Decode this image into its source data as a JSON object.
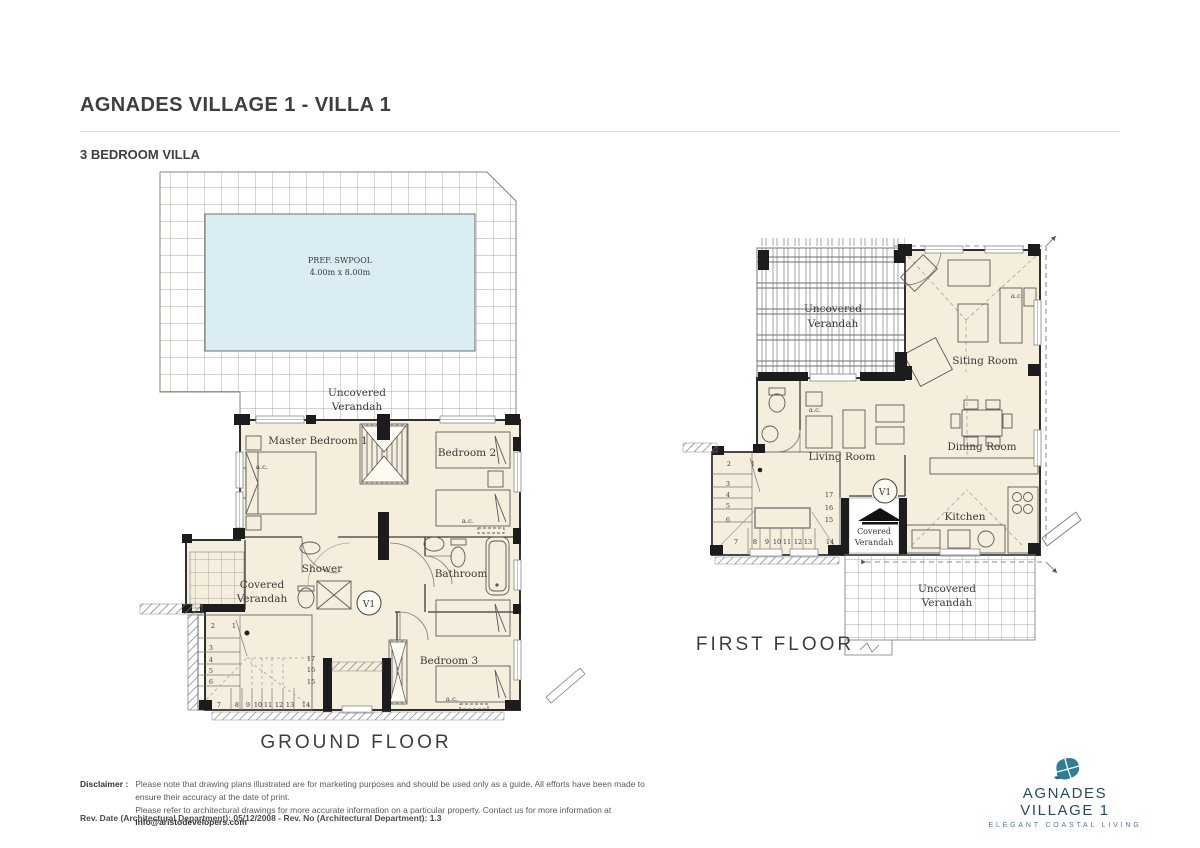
{
  "header": {
    "title": "AGNADES VILLAGE 1 - VILLA 1",
    "subtitle": "3 BEDROOM VILLA"
  },
  "ground_floor": {
    "floor_label": "GROUND FLOOR",
    "pool_label_line1": "PREF. SWPOOL",
    "pool_label_line2": "4.00m x 8.00m",
    "uncovered_verandah_line1": "Uncovered",
    "uncovered_verandah_line2": "Verandah",
    "covered_verandah_line1": "Covered",
    "covered_verandah_line2": "Verandah",
    "master_bedroom": "Master Bedroom 1",
    "bedroom2": "Bedroom 2",
    "bedroom3": "Bedroom 3",
    "shower": "Shower",
    "bathroom": "Bathroom",
    "vent_label": "V1",
    "ac_label": "a.c.",
    "stair_numbers": [
      "1",
      "2",
      "3",
      "4",
      "5",
      "6",
      "7",
      "8",
      "9",
      "10",
      "11",
      "12",
      "13",
      "14",
      "15",
      "16",
      "17"
    ]
  },
  "first_floor": {
    "floor_label": "FIRST FLOOR",
    "uncovered_verandah_top_line1": "Uncovered",
    "uncovered_verandah_top_line2": "Verandah",
    "uncovered_verandah_bottom_line1": "Uncovered",
    "uncovered_verandah_bottom_line2": "Verandah",
    "covered_verandah_line1": "Covered",
    "covered_verandah_line2": "Verandah",
    "siting_room": "Siting Room",
    "living_room": "Living Room",
    "dining_room": "Dining Room",
    "kitchen": "Kitchen",
    "vent_label": "V1",
    "ac_label": "a.c.",
    "stair_numbers": [
      "1",
      "2",
      "3",
      "4",
      "5",
      "6",
      "7",
      "8",
      "9",
      "10",
      "11",
      "12",
      "13",
      "14",
      "15",
      "16",
      "17"
    ]
  },
  "footer": {
    "disclaimer_label": "Disclaimer :",
    "disclaimer_line1": "Please note that drawing plans illustrated are for marketing purposes and should be used only as a guide. All efforts have been made to ensure their accuracy at the date of print.",
    "disclaimer_line2_prefix": "Please refer to architectural drawings for more accurate information on a particular property. Contact us for more information at ",
    "disclaimer_email": "info@aristodevelopers.com",
    "revision": "Rev. Date (Architectural Department): 05/12/2008 - Rev. No (Architectural Department): 1.3"
  },
  "logo": {
    "name": "AGNADES VILLAGE 1",
    "tagline": "ELEGANT COASTAL LIVING"
  },
  "colors": {
    "pool_fill": "#d9edf3",
    "room_fill": "#f5eedd",
    "wall": "#1c1c1c",
    "brand_navy": "#2b4a68",
    "brand_teal": "#2e7f96"
  }
}
